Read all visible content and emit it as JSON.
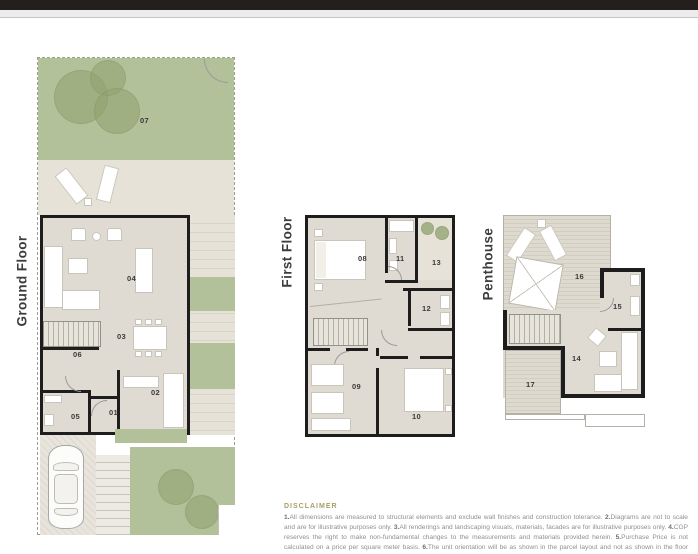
{
  "floors": {
    "ground": {
      "label": "Ground Floor"
    },
    "first": {
      "label": "First Floor"
    },
    "penthouse": {
      "label": "Penthouse"
    }
  },
  "rooms": {
    "r01": "01",
    "r02": "02",
    "r03": "03",
    "r04": "04",
    "r05": "05",
    "r06": "06",
    "r07": "07",
    "r08": "08",
    "r09": "09",
    "r10": "10",
    "r11": "11",
    "r12": "12",
    "r13": "13",
    "r14": "14",
    "r15": "15",
    "r16": "16",
    "r17": "17"
  },
  "disclaimer": {
    "heading": "DISCLAIMER",
    "items": [
      {
        "n": "1.",
        "t": "All dimensions are measured to structural elements and exclude wall finishes and construction tolerance. "
      },
      {
        "n": "2.",
        "t": "Diagrams are not to scale and are for illustrative purposes only. "
      },
      {
        "n": "3.",
        "t": "All renderings and landscaping visuals, materials, facades are for illustrative purposes only. "
      },
      {
        "n": "4.",
        "t": "CGP reserves the right to make non-fundamental changes to the measurements and materials provided herein. "
      },
      {
        "n": "5.",
        "t": "Purchase Price is not calculated on a price per square meter basis. "
      },
      {
        "n": "6.",
        "t": "The unit orientation will be as shown in the parcel layout and not as shown in the floor plans."
      }
    ]
  },
  "colors": {
    "wall": "#1d1d1d",
    "garden_green": "#b2c19a",
    "patio_beige": "#e6e2d8",
    "room_floor": "#dfdbd2",
    "deck_stripe": "#d1cdc1",
    "disclaimer_heading": "#a89e68",
    "disclaimer_text": "#8f8f8f",
    "top_bar": "#241f1d"
  }
}
